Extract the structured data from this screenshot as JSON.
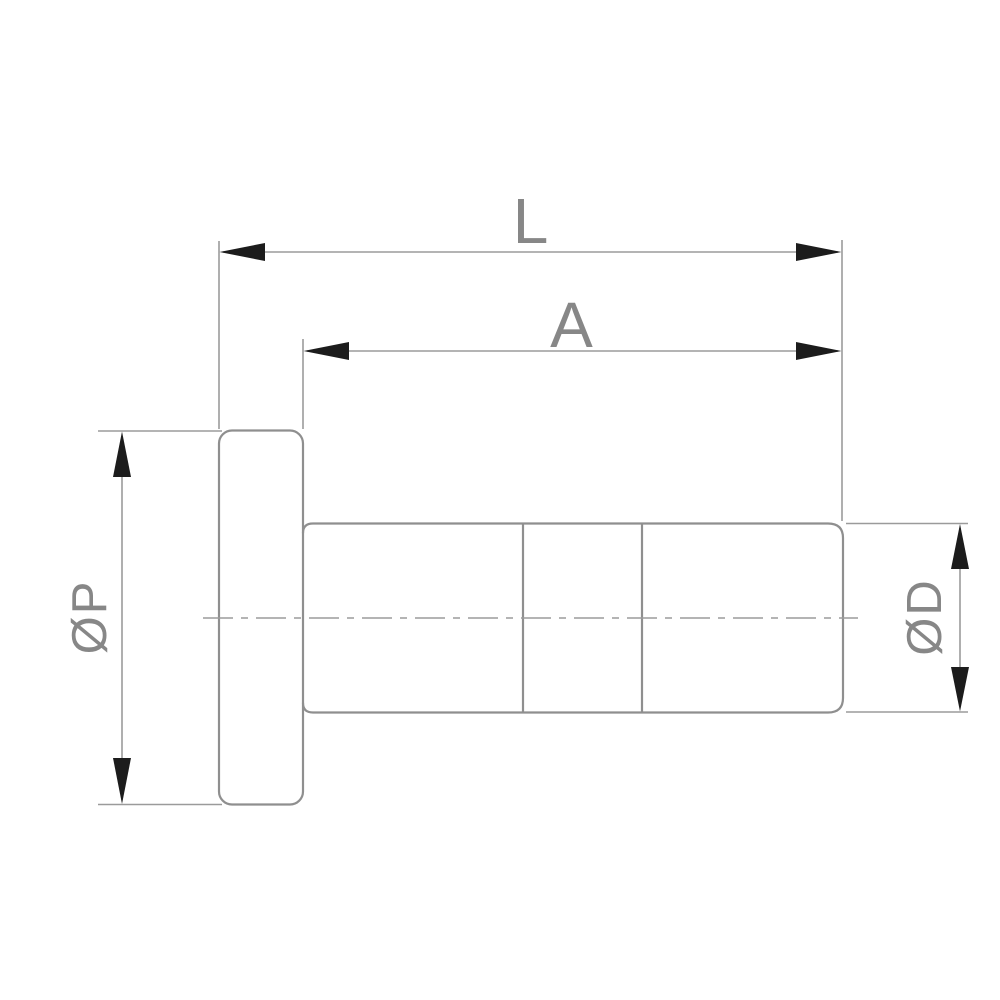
{
  "drawing": {
    "description": "technical-drawing-flanged-plug-fitting",
    "labels": {
      "length_total": "L",
      "length_body": "A",
      "flange_diameter": "ØP",
      "body_diameter": "ØD"
    },
    "colors": {
      "background": "#ffffff",
      "outline": "#8f8f8f",
      "dimension": "#9b9b9b",
      "arrow": "#1c1c1c",
      "text": "#878787"
    }
  }
}
